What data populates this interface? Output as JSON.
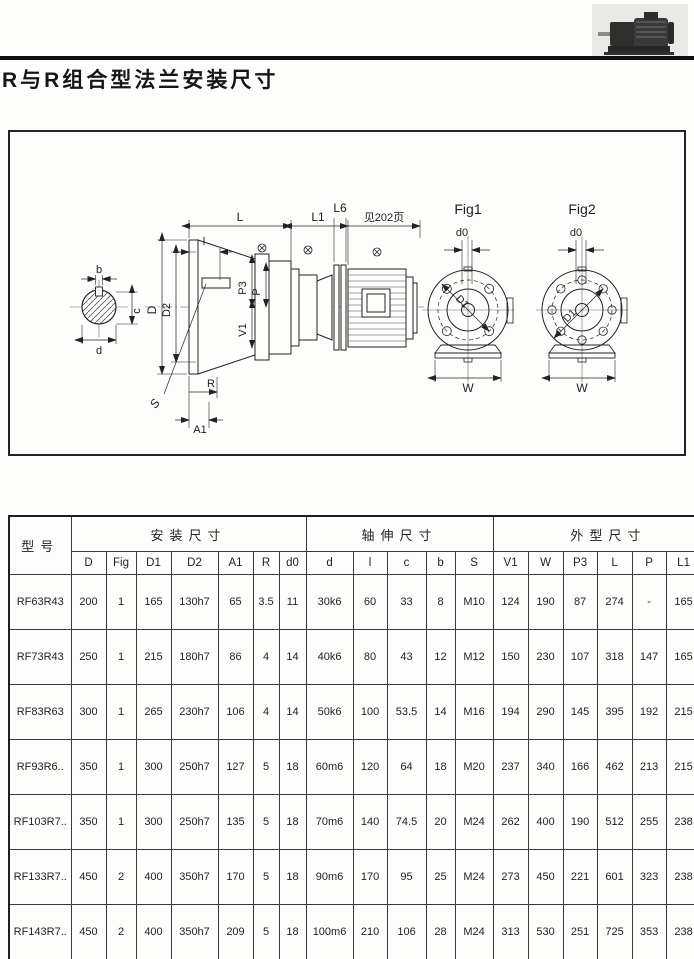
{
  "page": {
    "title": "R与R组合型法兰安装尺寸"
  },
  "drawing": {
    "fig1": "Fig1",
    "fig2": "Fig2",
    "note": "见202页",
    "dim_L": "L",
    "dim_L1": "L1",
    "dim_L6": "L6",
    "dim_l": "l",
    "dim_b": "b",
    "dim_c": "c",
    "dim_d": "d",
    "dim_D": "D",
    "dim_D2": "D2",
    "dim_P3": "P3",
    "dim_P": "P",
    "dim_V1": "V1",
    "dim_S": "S",
    "dim_R": "R",
    "dim_A1": "A1",
    "dim_d0": "d0",
    "dim_D1": "D1",
    "dim_W": "W"
  },
  "table": {
    "model_header": "型号",
    "groups": [
      {
        "label": "安装尺寸"
      },
      {
        "label": "轴伸尺寸"
      },
      {
        "label": "外型尺寸"
      }
    ],
    "subcols": [
      "D",
      "Fig",
      "D1",
      "D2",
      "A1",
      "R",
      "d0",
      "d",
      "l",
      "c",
      "b",
      "S",
      "V1",
      "W",
      "P3",
      "L",
      "P",
      "L1",
      "L6"
    ],
    "l6_note_lines": [
      "见",
      "72",
      "页"
    ],
    "rows": [
      {
        "model": "RF63R43",
        "v": [
          "200",
          "1",
          "165",
          "130h7",
          "65",
          "3.5",
          "11",
          "30k6",
          "60",
          "33",
          "8",
          "M10",
          "124",
          "190",
          "87",
          "274",
          "-",
          "165"
        ]
      },
      {
        "model": "RF73R43",
        "v": [
          "250",
          "1",
          "215",
          "180h7",
          "86",
          "4",
          "14",
          "40k6",
          "80",
          "43",
          "12",
          "M12",
          "150",
          "230",
          "107",
          "318",
          "147",
          "165"
        ]
      },
      {
        "model": "RF83R63",
        "v": [
          "300",
          "1",
          "265",
          "230h7",
          "106",
          "4",
          "14",
          "50k6",
          "100",
          "53.5",
          "14",
          "M16",
          "194",
          "290",
          "145",
          "395",
          "192",
          "215"
        ]
      },
      {
        "model": "RF93R6..",
        "v": [
          "350",
          "1",
          "300",
          "250h7",
          "127",
          "5",
          "18",
          "60m6",
          "120",
          "64",
          "18",
          "M20",
          "237",
          "340",
          "166",
          "462",
          "213",
          "215"
        ]
      },
      {
        "model": "RF103R7..",
        "v": [
          "350",
          "1",
          "300",
          "250h7",
          "135",
          "5",
          "18",
          "70m6",
          "140",
          "74.5",
          "20",
          "M24",
          "262",
          "400",
          "190",
          "512",
          "255",
          "238"
        ]
      },
      {
        "model": "RF133R7..",
        "v": [
          "450",
          "2",
          "400",
          "350h7",
          "170",
          "5",
          "18",
          "90m6",
          "170",
          "95",
          "25",
          "M24",
          "273",
          "450",
          "221",
          "601",
          "323",
          "238"
        ]
      },
      {
        "model": "RF143R7..",
        "v": [
          "450",
          "2",
          "400",
          "350h7",
          "209",
          "5",
          "18",
          "100m6",
          "210",
          "106",
          "28",
          "M24",
          "313",
          "530",
          "251",
          "725",
          "353",
          "238"
        ]
      }
    ]
  }
}
